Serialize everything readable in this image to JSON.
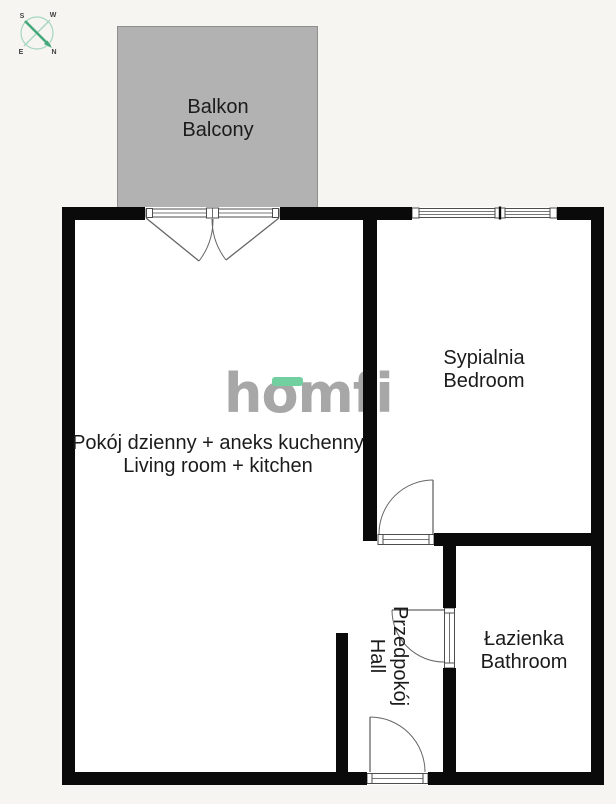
{
  "plan": {
    "rooms": [
      {
        "id": "balcony",
        "label_pl": "Balkon",
        "label_en": "Balcony"
      },
      {
        "id": "living",
        "label_pl": "Pokój dzienny + aneks kuchenny",
        "label_en": "Living room + kitchen"
      },
      {
        "id": "bedroom",
        "label_pl": "Sypialnia",
        "label_en": "Bedroom"
      },
      {
        "id": "hall",
        "label_pl": "Przedpokój",
        "label_en": "Hall"
      },
      {
        "id": "bathroom",
        "label_pl": "Łazienka",
        "label_en": "Bathroom"
      }
    ]
  },
  "logo": {
    "text": "homfi"
  },
  "compass": {
    "s": "S",
    "w": "W",
    "e": "E",
    "n": "N"
  },
  "colors": {
    "bg_outside": "#f6f5f2",
    "wall": "#0a0a0a",
    "balcony_fill": "#b2b2b2",
    "balcony_border": "#8f8f8f",
    "frame_stroke": "#4d4d4d",
    "door_stroke": "#666666",
    "label_text": "#1b1b1b",
    "logo_gray": "#a7a7a7",
    "logo_green": "#72cfa0",
    "compass_primary": "#44a87a",
    "compass_secondary": "#a5d7bf",
    "compass_letters": "#3f3f3f"
  }
}
